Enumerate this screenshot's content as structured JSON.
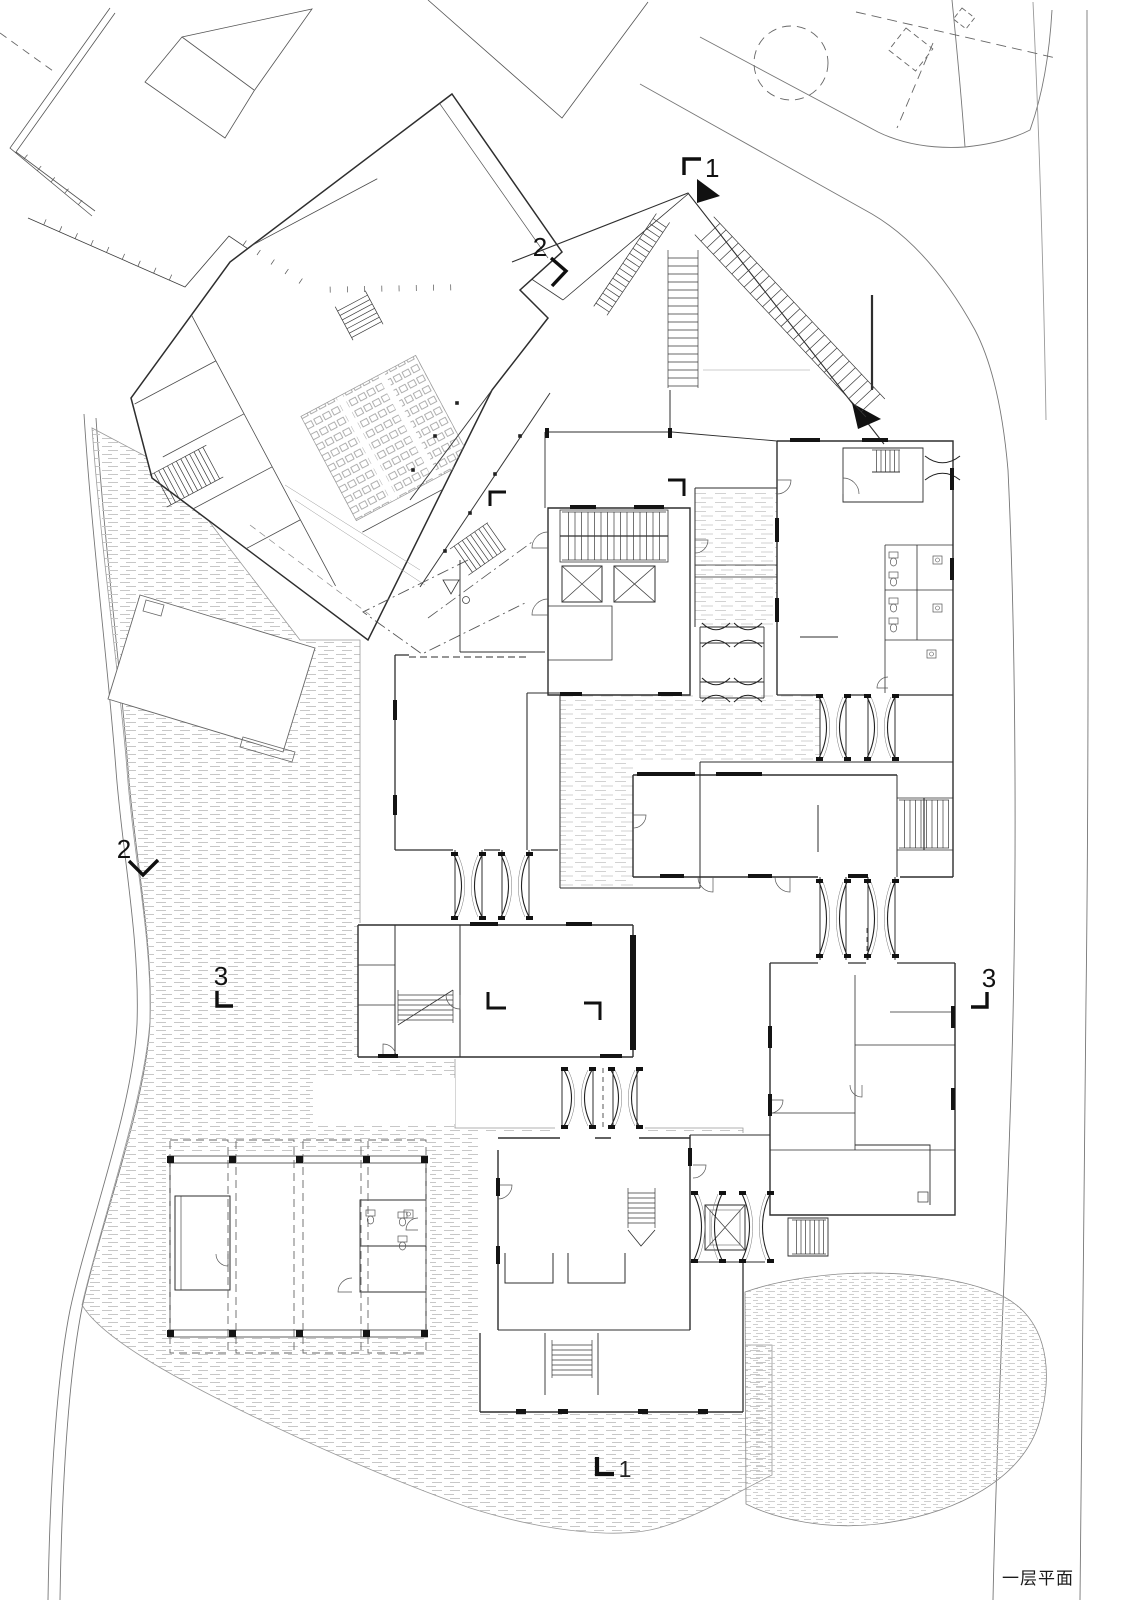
{
  "drawing": {
    "title": "一层平面",
    "kind": "architectural first floor plan"
  },
  "section_markers": {
    "one_top": "1",
    "one_bottom": "1",
    "two_top": "2",
    "two_left": "2",
    "three_left": "3",
    "three_right": "3"
  },
  "icons": {
    "section_cut_arrow": "filled-triangle",
    "section_corner_mark": "L-corner",
    "room_extent_mark": "L-corner"
  },
  "colors": {
    "background": "#ffffff",
    "wall_line": "#2e2e2e",
    "light_line": "#8a8a8a",
    "paving_hatch": "#c7c7c7",
    "pond_hatch": "#bfbfbf",
    "court_hatch": "#d2d2d2",
    "marker": "#0f0f0f"
  }
}
